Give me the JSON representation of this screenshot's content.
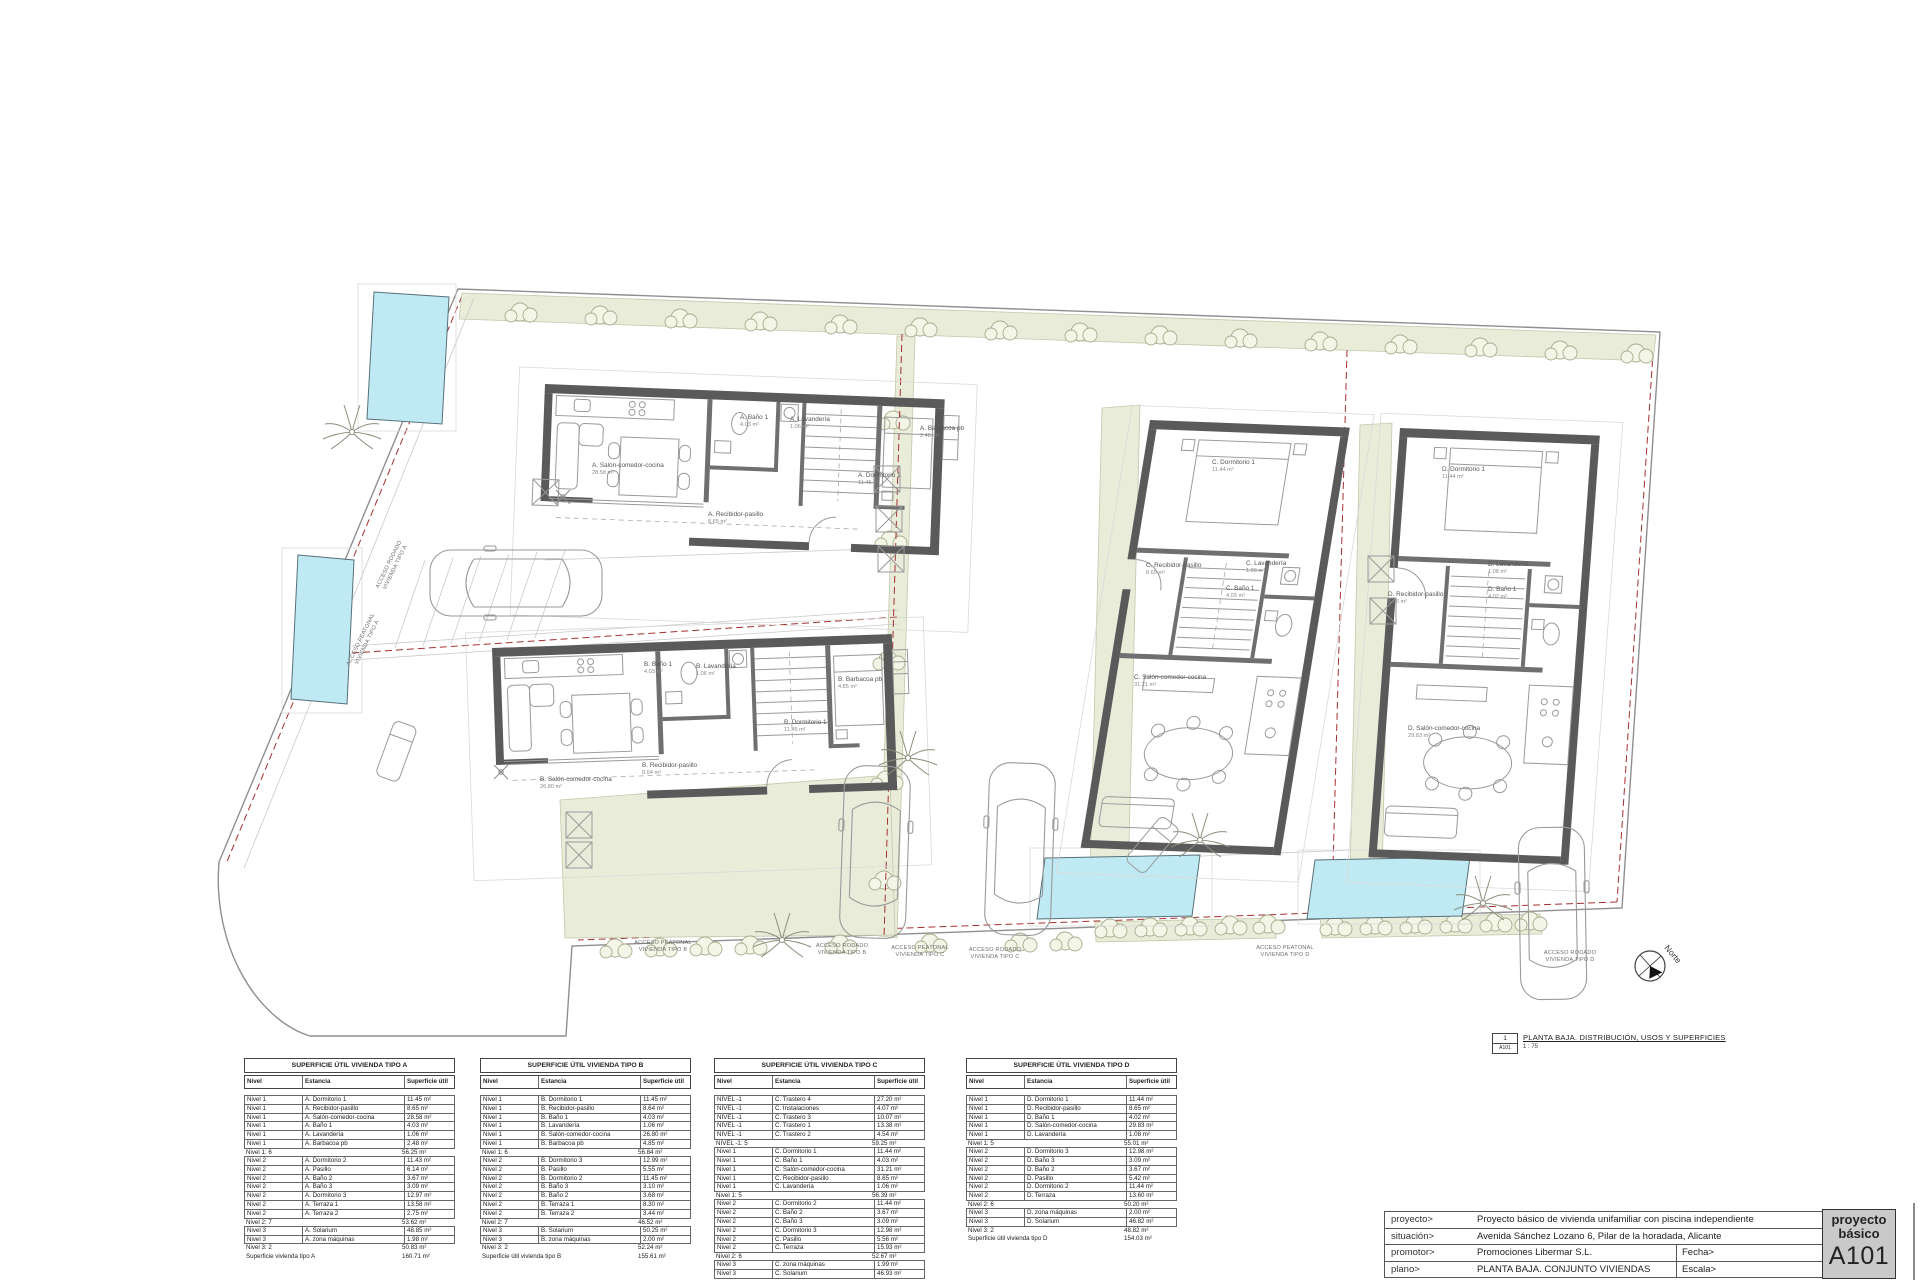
{
  "drawing_label": {
    "ref_num": "1",
    "ref_sheet": "A101",
    "title": "PLANTA BAJA. DISTRIBUCIÓN, USOS Y SUPERFICIES",
    "scale": "1 : 75"
  },
  "titleblock": {
    "rows": [
      {
        "label": "proyecto>",
        "value": "Proyecto básico de vivienda unifamiliar con piscina independiente"
      },
      {
        "label": "situación>",
        "value": "Avenida Sánchez Lozano 6, Pilar de la horadada, Alicante"
      },
      {
        "label": "promotor>",
        "value": "Promociones Libermar S.L."
      },
      {
        "label": "plano>",
        "value": "PLANTA BAJA. CONJUNTO VIVIENDAS"
      }
    ],
    "fecha_label": "Fecha>",
    "fecha_value": "Julio 2022",
    "escala_label": "Escala>",
    "escala_value": "1 : 75",
    "stamp_line1": "proyecto",
    "stamp_line2": "básico",
    "sheet_number": "A101"
  },
  "plan": {
    "north_label": "Norte",
    "access_labels": {
      "a_rodado": {
        "l1": "ACCESO RODADO",
        "l2": "VIVIENDA TIPO A"
      },
      "a_peatonal": {
        "l1": "ACCESO PEATONAL",
        "l2": "VIVIENDA TIPO A"
      },
      "b_peatonal": {
        "l1": "ACCESO PEATONAL",
        "l2": "VIVIENDA TIPO B"
      },
      "b_rodado": {
        "l1": "ACCESO RODADO",
        "l2": "VIVIENDA TIPO B"
      },
      "c_peatonal": {
        "l1": "ACCESO PEATONAL",
        "l2": "VIVIENDA TIPO C"
      },
      "c_rodado": {
        "l1": "ACCESO RODADO",
        "l2": "VIVIENDA TIPO C"
      },
      "d_peatonal": {
        "l1": "ACCESO PEATONAL",
        "l2": "VIVIENDA TIPO D"
      },
      "d_rodado": {
        "l1": "ACCESO RODADO",
        "l2": "VIVIENDA TIPO D"
      }
    },
    "rooms": {
      "a": [
        {
          "name": "A. Salón-comedor-cocina",
          "area": "28.58 m²"
        },
        {
          "name": "A. Baño 1",
          "area": "4.03 m²"
        },
        {
          "name": "A. Lavandería",
          "area": "1.06 m²"
        },
        {
          "name": "A. Dormitorio 1",
          "area": "11.45 m²"
        },
        {
          "name": "A. Recibidor-pasillo",
          "area": "8.65 m²"
        },
        {
          "name": "A. Barbacoa pb",
          "area": "2.48 m²"
        }
      ],
      "b": [
        {
          "name": "B. Salón-comedor-cocina",
          "area": "26.80 m²"
        },
        {
          "name": "B. Baño 1",
          "area": "4.03 m²"
        },
        {
          "name": "B. Lavandería",
          "area": "1.06 m²"
        },
        {
          "name": "B. Dormitorio 1",
          "area": "11.45 m²"
        },
        {
          "name": "B. Recibidor-pasillo",
          "area": "8.64 m²"
        },
        {
          "name": "B. Barbacoa pb",
          "area": "4.85 m²"
        }
      ],
      "c": [
        {
          "name": "C. Dormitorio 1",
          "area": "11.44 m²"
        },
        {
          "name": "C. Recibidor-pasillo",
          "area": "8.65 m²"
        },
        {
          "name": "C. Lavandería",
          "area": "1.06 m²"
        },
        {
          "name": "C. Baño 1",
          "area": "4.03 m²"
        },
        {
          "name": "C. Salón-comedor-cocina",
          "area": "31.21 m²"
        }
      ],
      "d": [
        {
          "name": "D. Dormitorio 1",
          "area": "11.44 m²"
        },
        {
          "name": "D. Recibidor-pasillo",
          "area": "8.65 m²"
        },
        {
          "name": "D. Lavandería",
          "area": "1.08 m²"
        },
        {
          "name": "D. Baño 1",
          "area": "4.02 m²"
        },
        {
          "name": "D. Salón-comedor-cocina",
          "area": "29.83 m²"
        }
      ]
    },
    "colors": {
      "pool": "#bfeaf3",
      "garden": "#eaecda",
      "wall": "#5a5a5a",
      "parcel_line": "#a53030"
    }
  },
  "tables": [
    {
      "title": "SUPERFICIE ÚTIL VIVIENDA TIPO A",
      "headers": [
        "Nivel",
        "Estancia",
        "Superficie útil"
      ],
      "rows": [
        [
          "Nivel 1",
          "A. Dormitorio 1",
          "11.45 m²",
          "i"
        ],
        [
          "Nivel 1",
          "A. Recibidor-pasillo",
          "8.65 m²",
          "i"
        ],
        [
          "Nivel 1",
          "A. Salón-comedor-cocina",
          "28.58 m²",
          "i"
        ],
        [
          "Nivel 1",
          "A. Baño 1",
          "4.03 m²",
          "i"
        ],
        [
          "Nivel 1",
          "A. Lavandería",
          "1.06 m²",
          "i"
        ],
        [
          "Nivel 1",
          "A. Barbacoa pb",
          "2.48 m²",
          "i"
        ],
        [
          "Nivel 1: 6",
          "",
          "56.25 m²",
          "s"
        ],
        [
          "Nivel 2",
          "A. Dormitorio 2",
          "11.43 m²",
          "i"
        ],
        [
          "Nivel 2",
          "A. Pasillo",
          "6.14 m²",
          "i"
        ],
        [
          "Nivel 2",
          "A. Baño 2",
          "3.67 m²",
          "i"
        ],
        [
          "Nivel 2",
          "A. Baño 3",
          "3.09 m²",
          "i"
        ],
        [
          "Nivel 2",
          "A. Dormitorio 3",
          "12.97 m²",
          "i"
        ],
        [
          "Nivel 2",
          "A. Terraza 1",
          "13.58 m²",
          "i"
        ],
        [
          "Nivel 2",
          "A. Terraza 2",
          "2.75 m²",
          "i"
        ],
        [
          "Nivel 2: 7",
          "",
          "53.62 m²",
          "s"
        ],
        [
          "Nivel 3",
          "A. Solarium",
          "48.85 m²",
          "i"
        ],
        [
          "Nivel 3",
          "A. zona máquinas",
          "1.98 m²",
          "i"
        ],
        [
          "Nivel 3: 2",
          "",
          "50.83 m²",
          "s"
        ],
        [
          "Superficie vivienda tipo A",
          "",
          "160.71 m²",
          "t"
        ]
      ]
    },
    {
      "title": "SUPERFICIE ÚTIL VIVIENDA TIPO B",
      "headers": [
        "Nivel",
        "Estancia",
        "Superficie útil"
      ],
      "rows": [
        [
          "Nivel 1",
          "B. Dormitorio 1",
          "11.45 m²",
          "i"
        ],
        [
          "Nivel 1",
          "B. Recibidor-pasillo",
          "8.64 m²",
          "i"
        ],
        [
          "Nivel 1",
          "B. Baño 1",
          "4.03 m²",
          "i"
        ],
        [
          "Nivel 1",
          "B. Lavandería",
          "1.06 m²",
          "i"
        ],
        [
          "Nivel 1",
          "B. Salón-comedor-cocina",
          "26.80 m²",
          "i"
        ],
        [
          "Nivel 1",
          "B. Barbacoa pb",
          "4.85 m²",
          "i"
        ],
        [
          "Nivel 1: 6",
          "",
          "56.84 m²",
          "s"
        ],
        [
          "Nivel 2",
          "B. Dormitorio 3",
          "12.99 m²",
          "i"
        ],
        [
          "Nivel 2",
          "B. Pasillo",
          "5.55 m²",
          "i"
        ],
        [
          "Nivel 2",
          "B. Dormitorio 2",
          "11.45 m²",
          "i"
        ],
        [
          "Nivel 2",
          "B. Baño 3",
          "3.10 m²",
          "i"
        ],
        [
          "Nivel 2",
          "B. Baño 2",
          "3.68 m²",
          "i"
        ],
        [
          "Nivel 2",
          "B. Terraza 1",
          "8.30 m²",
          "i"
        ],
        [
          "Nivel 2",
          "B. Terraza 2",
          "3.44 m²",
          "i"
        ],
        [
          "Nivel 2: 7",
          "",
          "46.52 m²",
          "s"
        ],
        [
          "Nivel 3",
          "B. Solarium",
          "50.25 m²",
          "i"
        ],
        [
          "Nivel 3",
          "B. zona máquinas",
          "2.00 m²",
          "i"
        ],
        [
          "Nivel 3: 2",
          "",
          "52.24 m²",
          "s"
        ],
        [
          "Superficie útil vivienda tipo B",
          "",
          "155.61 m²",
          "t"
        ]
      ]
    },
    {
      "title": "SUPERFICIE ÚTIL VIVIENDA TIPO C",
      "headers": [
        "Nivel",
        "Estancia",
        "Superficie útil"
      ],
      "rows": [
        [
          "NIVEL -1",
          "C. Trastero 4",
          "27.20 m²",
          "i"
        ],
        [
          "NIVEL -1",
          "C. Instalaciones",
          "4.07 m²",
          "i"
        ],
        [
          "NIVEL -1",
          "C. Trastero 3",
          "10.07 m²",
          "i"
        ],
        [
          "NIVEL -1",
          "C. Trastero 1",
          "13.38 m²",
          "i"
        ],
        [
          "NIVEL -1",
          "C. Trastero 2",
          "4.54 m²",
          "i"
        ],
        [
          "NIVEL -1: 5",
          "",
          "59.25 m²",
          "s"
        ],
        [
          "Nivel 1",
          "C. Dormitorio 1",
          "11.44 m²",
          "i"
        ],
        [
          "Nivel 1",
          "C. Baño 1",
          "4.03 m²",
          "i"
        ],
        [
          "Nivel 1",
          "C. Salón-comedor-cocina",
          "31.21 m²",
          "i"
        ],
        [
          "Nivel 1",
          "C. Recibidor-pasillo",
          "8.65 m²",
          "i"
        ],
        [
          "Nivel 1",
          "C. Lavandería",
          "1.06 m²",
          "i"
        ],
        [
          "Nivel 1: 5",
          "",
          "56.39 m²",
          "s"
        ],
        [
          "Nivel 2",
          "C. Dormitorio 2",
          "11.44 m²",
          "i"
        ],
        [
          "Nivel 2",
          "C. Baño 2",
          "3.67 m²",
          "i"
        ],
        [
          "Nivel 2",
          "C. Baño 3",
          "3.09 m²",
          "i"
        ],
        [
          "Nivel 2",
          "C. Dormitorio 3",
          "12.98 m²",
          "i"
        ],
        [
          "Nivel 2",
          "C. Pasillo",
          "5.56 m²",
          "i"
        ],
        [
          "Nivel 2",
          "C. Terraza",
          "15.93 m²",
          "i"
        ],
        [
          "Nivel 2: 6",
          "",
          "52.67 m²",
          "s"
        ],
        [
          "Nivel 3",
          "C. zona máquinas",
          "1.99 m²",
          "i"
        ],
        [
          "Nivel 3",
          "C. Solarium",
          "46.93 m²",
          "i"
        ]
      ]
    },
    {
      "title": "SUPERFICIE ÚTIL VIVIENDA TIPO D",
      "headers": [
        "Nivel",
        "Estancia",
        "Superficie útil"
      ],
      "rows": [
        [
          "Nivel 1",
          "D. Dormitorio 1",
          "11.44 m²",
          "i"
        ],
        [
          "Nivel 1",
          "D. Recibidor-pasillo",
          "8.65 m²",
          "i"
        ],
        [
          "Nivel 1",
          "D. Baño 1",
          "4.02 m²",
          "i"
        ],
        [
          "Nivel 1",
          "D. Salón-comedor-cocina",
          "29.83 m²",
          "i"
        ],
        [
          "Nivel 1",
          "D. Lavandería",
          "1.08 m²",
          "i"
        ],
        [
          "Nivel 1: 5",
          "",
          "55.01 m²",
          "s"
        ],
        [
          "Nivel 2",
          "D. Dormitorio 3",
          "12.98 m²",
          "i"
        ],
        [
          "Nivel 2",
          "D. Baño 3",
          "3.09 m²",
          "i"
        ],
        [
          "Nivel 2",
          "D. Baño 2",
          "3.67 m²",
          "i"
        ],
        [
          "Nivel 2",
          "D. Pasillo",
          "5.42 m²",
          "i"
        ],
        [
          "Nivel 2",
          "D. Dormitorio 2",
          "11.44 m²",
          "i"
        ],
        [
          "Nivel 2",
          "D. Terraza",
          "13.60 m²",
          "i"
        ],
        [
          "Nivel 2: 6",
          "",
          "50.20 m²",
          "s"
        ],
        [
          "Nivel 3",
          "D. zona máquinas",
          "2.00 m²",
          "i"
        ],
        [
          "Nivel 3",
          "D. Solarium",
          "46.82 m²",
          "i"
        ],
        [
          "Nivel 3: 2",
          "",
          "48.82 m²",
          "s"
        ],
        [
          "Superficie útil vivienda tipo D",
          "",
          "154.03 m²",
          "t"
        ]
      ]
    }
  ]
}
